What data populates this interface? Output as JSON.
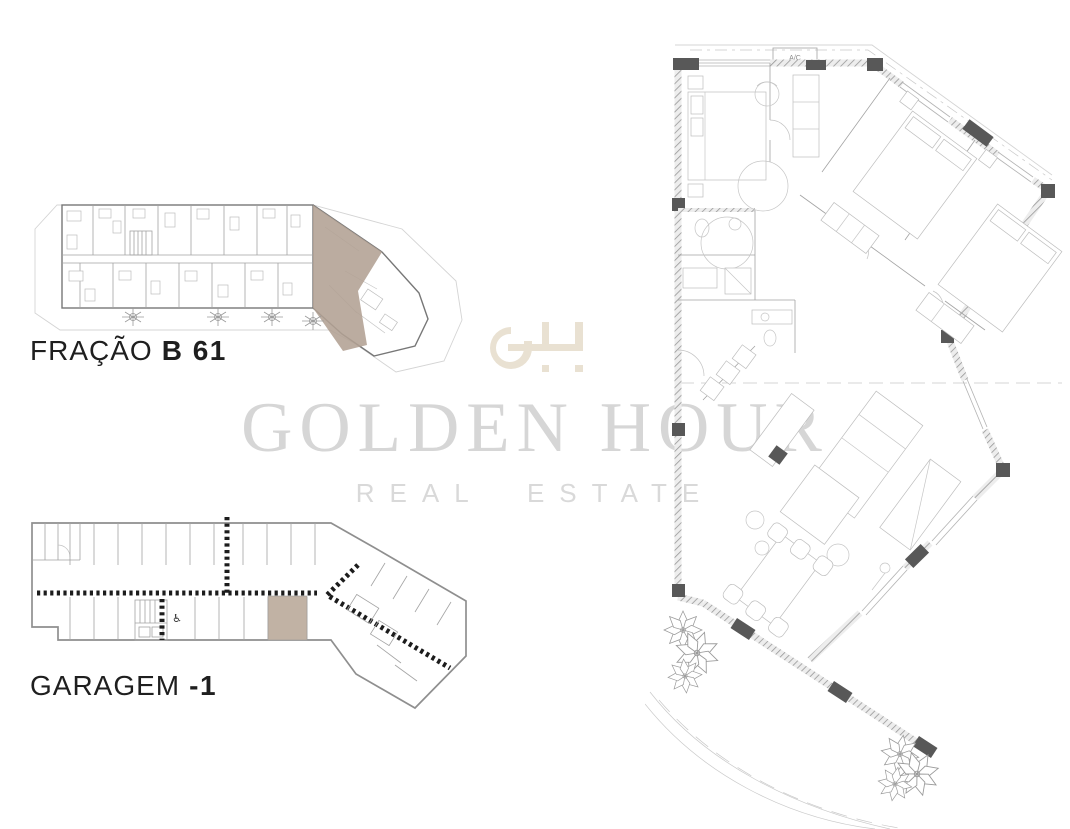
{
  "page": {
    "background": "#ffffff"
  },
  "watermark": {
    "monogram": "GH",
    "monogram_color": "#e9e1d2",
    "brand_name": "GOLDEN HOUR",
    "brand_tagline": "REAL ESTATE",
    "brand_color": "#d6d6d6",
    "tagline_color": "#d9d9d9"
  },
  "labels": {
    "fraction": {
      "prefix": "FRAÇÃO",
      "code": "B 61"
    },
    "garage": {
      "prefix": "GARAGEM",
      "code": "-1"
    }
  },
  "plans": {
    "building": {
      "highlight_color": "#b2a193"
    },
    "garage": {
      "highlight_color": "#c1b2a4",
      "accessible_icon": "♿"
    },
    "apartment": {
      "ac_label": "A/C"
    }
  }
}
